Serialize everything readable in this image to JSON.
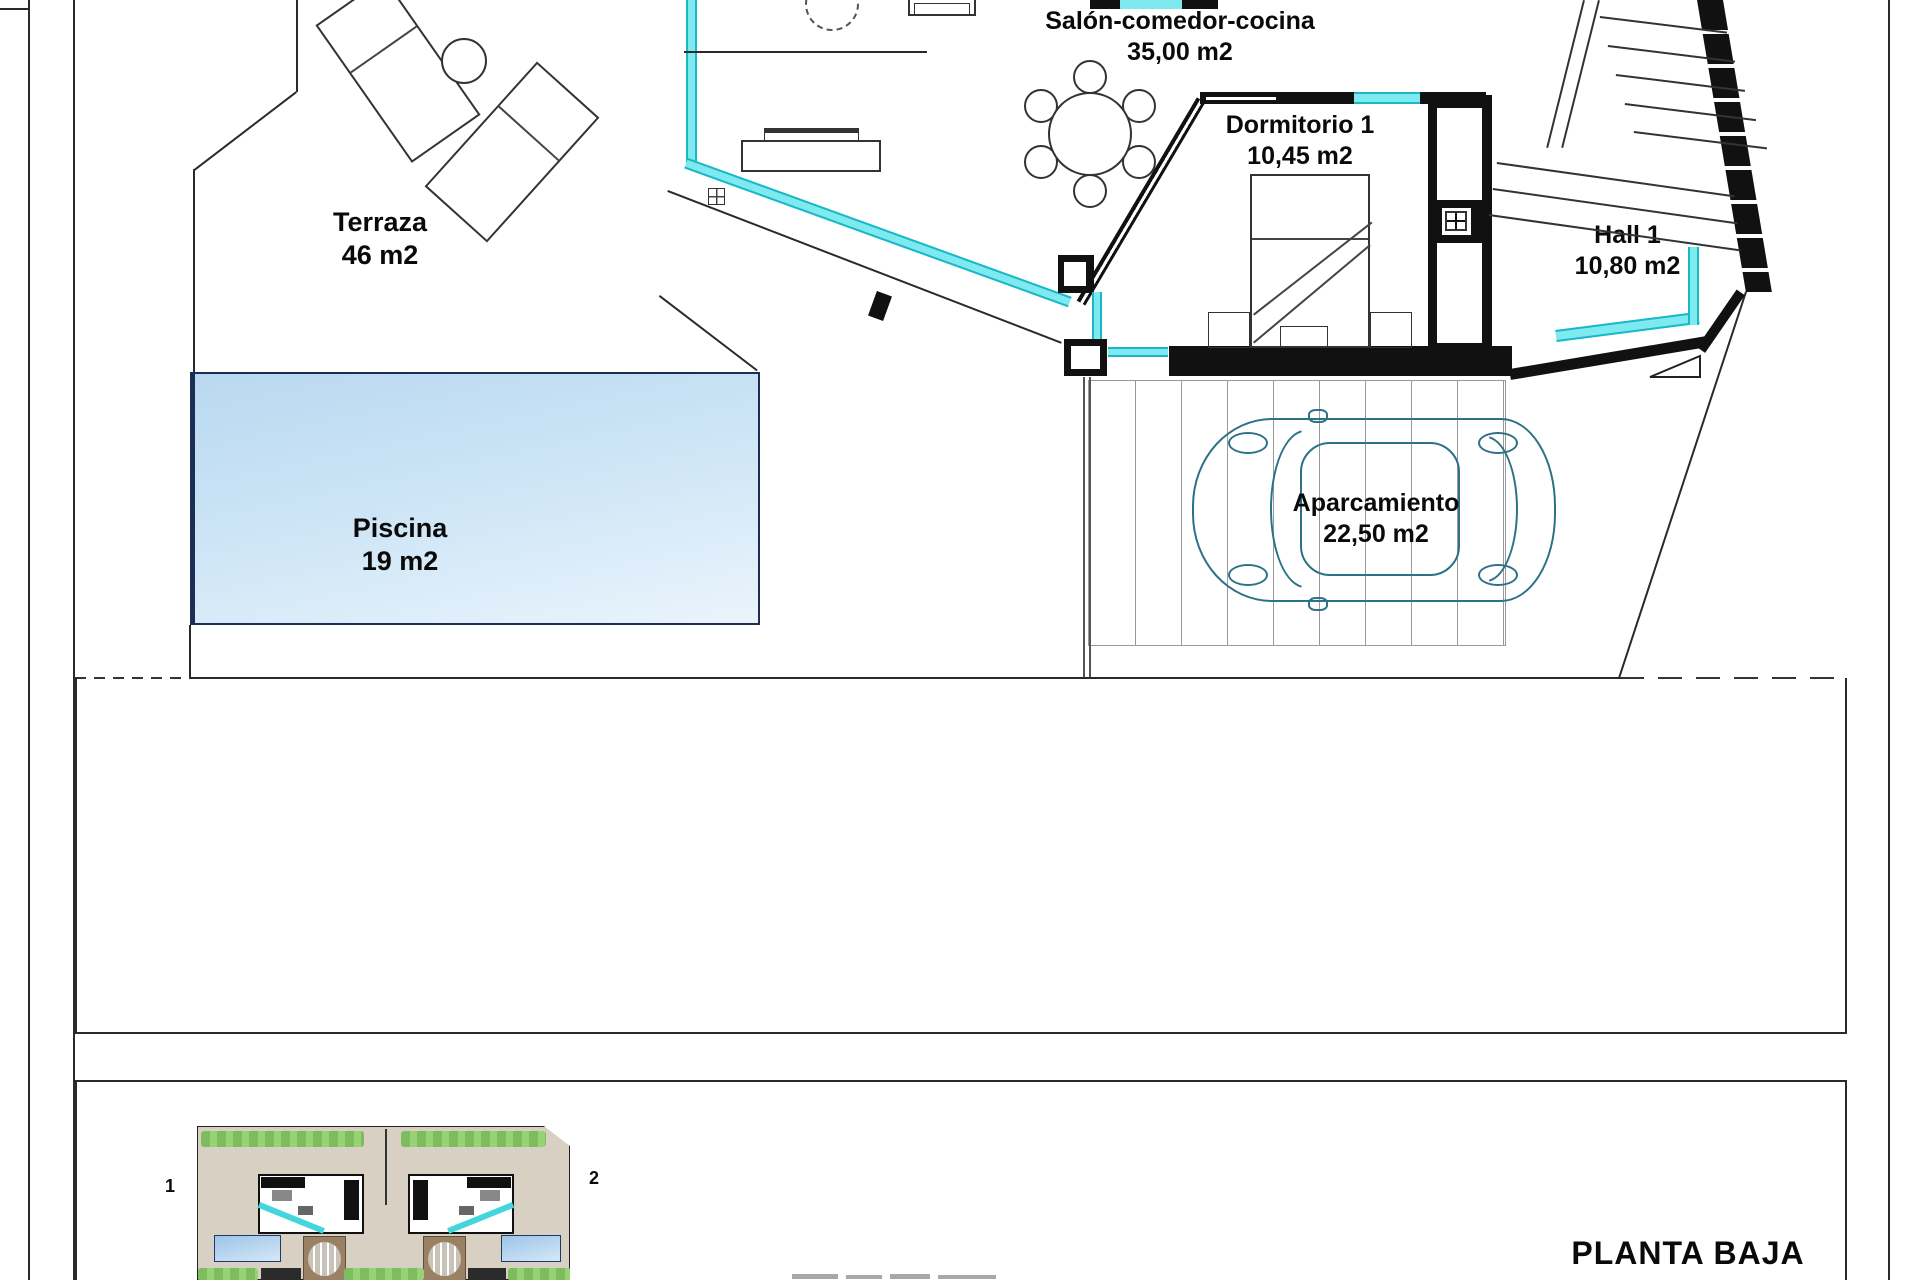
{
  "title": "PLANTA BAJA",
  "rooms": {
    "terraza": {
      "label": "Terraza",
      "area": "46 m2"
    },
    "piscina": {
      "label": "Piscina",
      "area": "19 m2"
    },
    "salon": {
      "label": "Salón-comedor-cocina",
      "area": "35,00 m2"
    },
    "dormitorio": {
      "label": "Dormitorio 1",
      "area": "10,45 m2"
    },
    "hall": {
      "label": "Hall 1",
      "area": "10,80 m2"
    },
    "aparcamiento": {
      "label": "Aparcamiento",
      "area": "22,50 m2"
    }
  },
  "site_plan": {
    "unit1": "1",
    "unit2": "2"
  },
  "colors": {
    "glazing": "#7eeaf0",
    "glazing_line": "#18b8c6",
    "pool_top": "#b9d8f0",
    "pool_bottom": "#eaf4fc",
    "wall": "#111111",
    "car_outline": "#2d7186",
    "site_ground": "#d8d0c3"
  }
}
